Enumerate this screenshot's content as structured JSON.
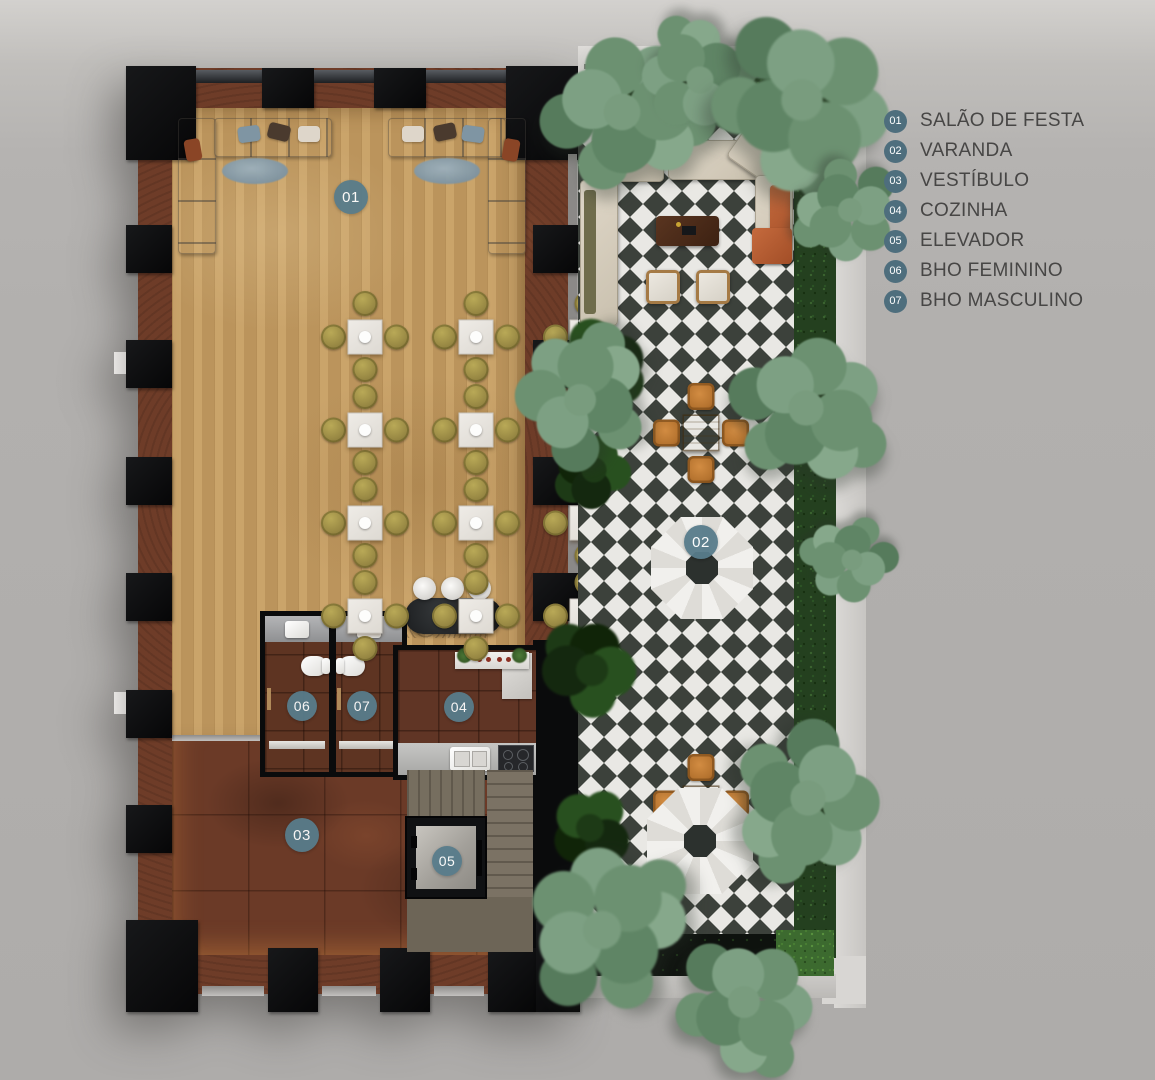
{
  "legend": {
    "items": [
      {
        "number": "01",
        "label": "SALÃO DE FESTA"
      },
      {
        "number": "02",
        "label": "VARANDA"
      },
      {
        "number": "03",
        "label": "VESTÍBULO"
      },
      {
        "number": "04",
        "label": "COZINHA"
      },
      {
        "number": "05",
        "label": "ELEVADOR"
      },
      {
        "number": "06",
        "label": "BHO FEMININO"
      },
      {
        "number": "07",
        "label": "BHO MASCULINO"
      }
    ]
  },
  "colors": {
    "background": "#b2b0ae",
    "legend_badge": "#4e6e7d",
    "marker_badge": "#587c8b",
    "legend_text": "#474645",
    "tile_dark": "#3c413b",
    "tile_light": "#e9e8e4",
    "wood_floor": "#c49c62",
    "rust_wall": "#6e3c28",
    "column_black": "#0b0c0e",
    "hedge_green": "#24401f",
    "umbrella_white": "#eceae6",
    "terracotta": "#b55c33"
  }
}
